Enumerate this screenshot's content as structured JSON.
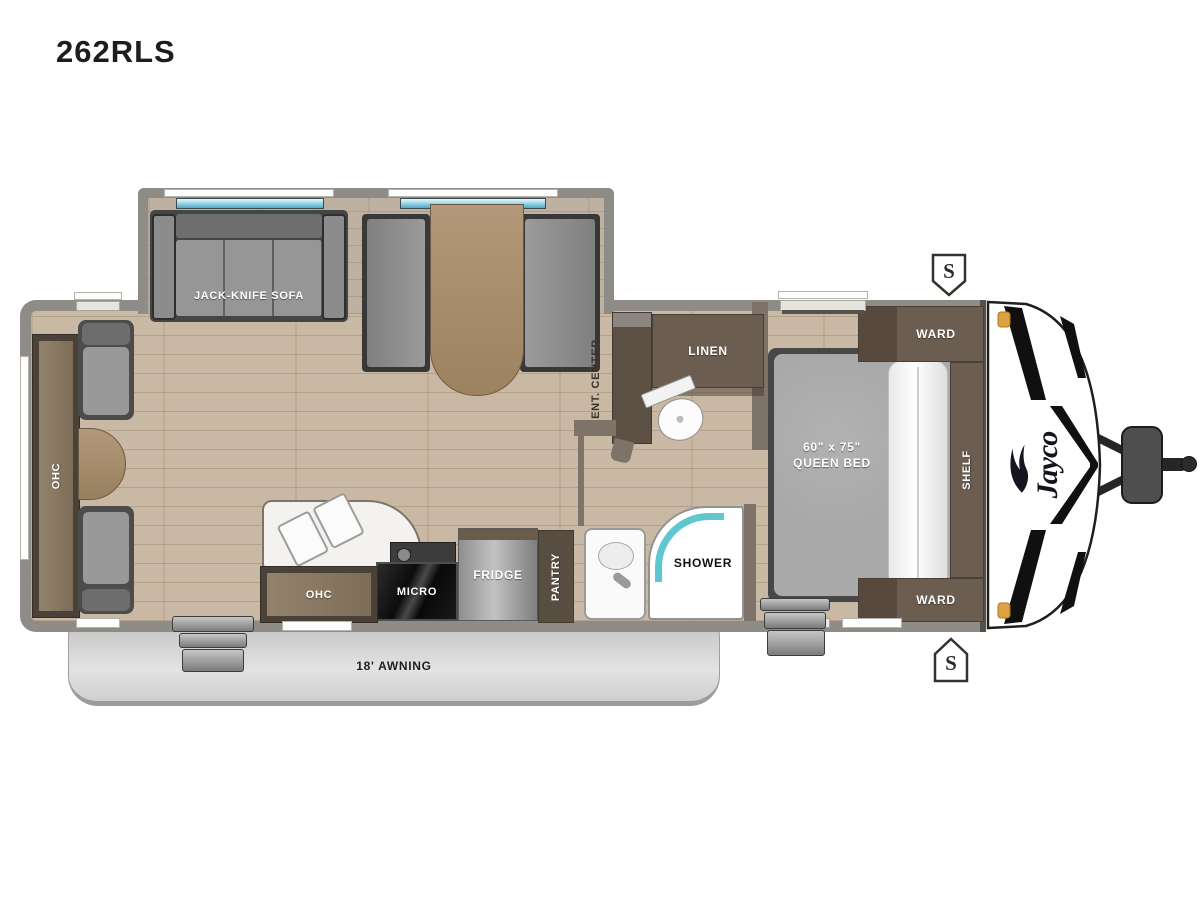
{
  "title": "262RLS",
  "brand": {
    "name": "Jayco"
  },
  "labels": {
    "sofa": "JACK-KNIFE SOFA",
    "rear_ohc": "OHC",
    "ent_center": "ENT. CENTER",
    "linen": "LINEN",
    "shower": "SHOWER",
    "kitchen_ohc": "OHC",
    "micro": "MICRO",
    "fridge": "FRIDGE",
    "pantry": "PANTRY",
    "ward_top": "WARD",
    "ward_bottom": "WARD",
    "shelf": "SHELF",
    "bed_size": "60\" x 75\"",
    "bed_type": "QUEEN BED",
    "awning": "18' AWNING",
    "speaker_top": "S",
    "speaker_bottom": "S"
  },
  "colors": {
    "wall": "#8f8b86",
    "floor": "#c9b8a4",
    "cabinet": "#5f5347",
    "shower_teal": "#5fc7cd",
    "awning": "#d6d6d6",
    "marker_light": "#dfa23f",
    "micro_black": "#111111"
  }
}
